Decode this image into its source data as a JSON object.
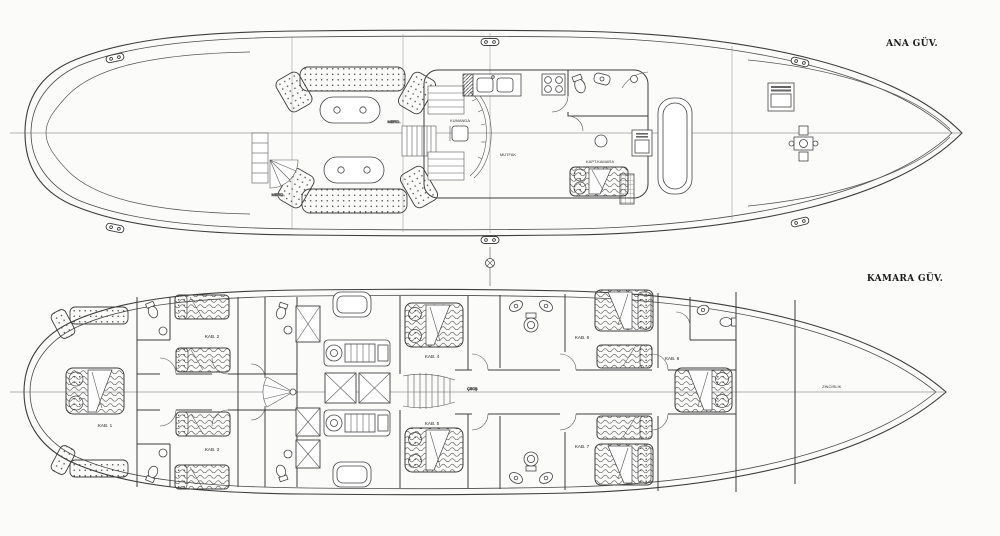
{
  "drawing": {
    "background": "#fbfbfa",
    "line_color": "#3d3d3d",
    "decks": {
      "main": {
        "title": "ANA GÜV.",
        "labels": {
          "helm": "KUMANDA",
          "galley": "MUTFAK",
          "captain_cabin": "KAPT.KAMARA",
          "stairs": "MERD."
        }
      },
      "cabin": {
        "title": "KAMARA GÜV.",
        "labels": {
          "exit": "ÇIKIŞ",
          "chain_locker": "ZİNCİRLİK",
          "cabins": [
            "KAB. 1",
            "KAB. 2",
            "KAB. 3",
            "KAB. 4",
            "KAB. 5",
            "KAB. 6",
            "KAB. 7",
            "KAB. 8"
          ]
        }
      }
    }
  }
}
